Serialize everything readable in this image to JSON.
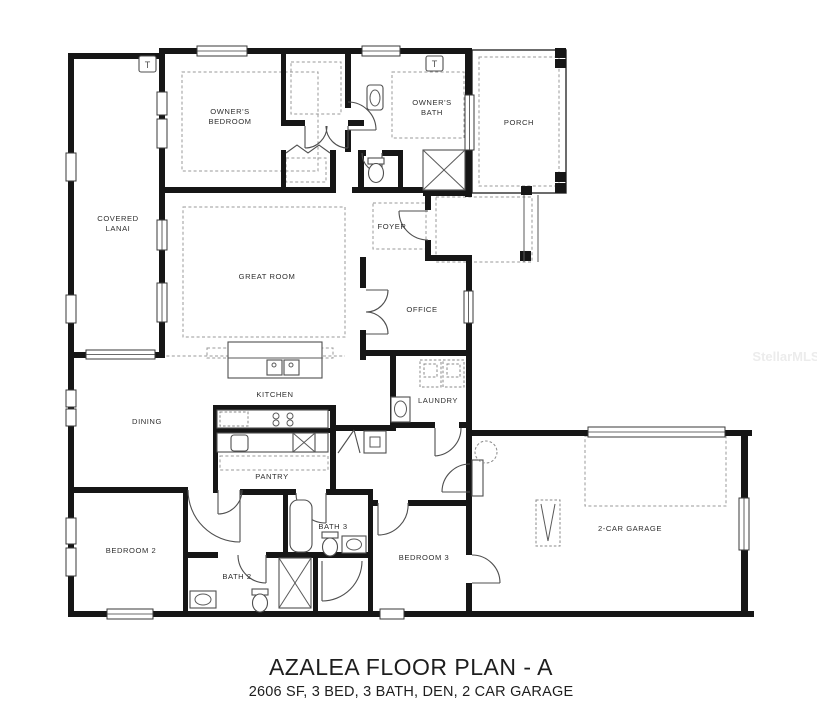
{
  "title": {
    "main": "AZALEA FLOOR PLAN - A",
    "subtitle": "2606 SF, 3 BED, 3 BATH, DEN, 2 CAR GARAGE"
  },
  "plan_facts": {
    "sqft": "2606 SF",
    "beds": "3 BED",
    "baths": "3 BATH",
    "den": "DEN",
    "garage": "2 CAR GARAGE",
    "plan_name": "AZALEA",
    "variant": "A"
  },
  "watermark": {
    "text": "StellarMLS"
  },
  "markers": {
    "t": "T"
  },
  "rooms": {
    "owners_bedroom": {
      "line1": "OWNER'S",
      "line2": "BEDROOM"
    },
    "owners_bath": {
      "line1": "OWNER'S",
      "line2": "BATH"
    },
    "porch": {
      "label": "PORCH"
    },
    "covered_lanai": {
      "line1": "COVERED",
      "line2": "LANAI"
    },
    "foyer": {
      "label": "FOYER"
    },
    "great_room": {
      "label": "GREAT ROOM"
    },
    "office": {
      "label": "OFFICE"
    },
    "kitchen": {
      "label": "KITCHEN"
    },
    "dining": {
      "label": "DINING"
    },
    "laundry": {
      "label": "LAUNDRY"
    },
    "pantry": {
      "label": "PANTRY"
    },
    "bedroom_2": {
      "label": "BEDROOM 2"
    },
    "bath_2": {
      "label": "BATH 2"
    },
    "bath_3": {
      "label": "BATH 3"
    },
    "bedroom_3": {
      "label": "BEDROOM 3"
    },
    "garage": {
      "label": "2-CAR GARAGE"
    }
  },
  "colors": {
    "background": "#ffffff",
    "wall": "#161616",
    "thin_line": "#2e2e2e",
    "dashed_line": "#9a9a9a",
    "fixture_line": "#4f4f4f",
    "label_text": "#2f2f2f",
    "title_text": "#1e1e1e",
    "watermark_text": "#ececec"
  }
}
